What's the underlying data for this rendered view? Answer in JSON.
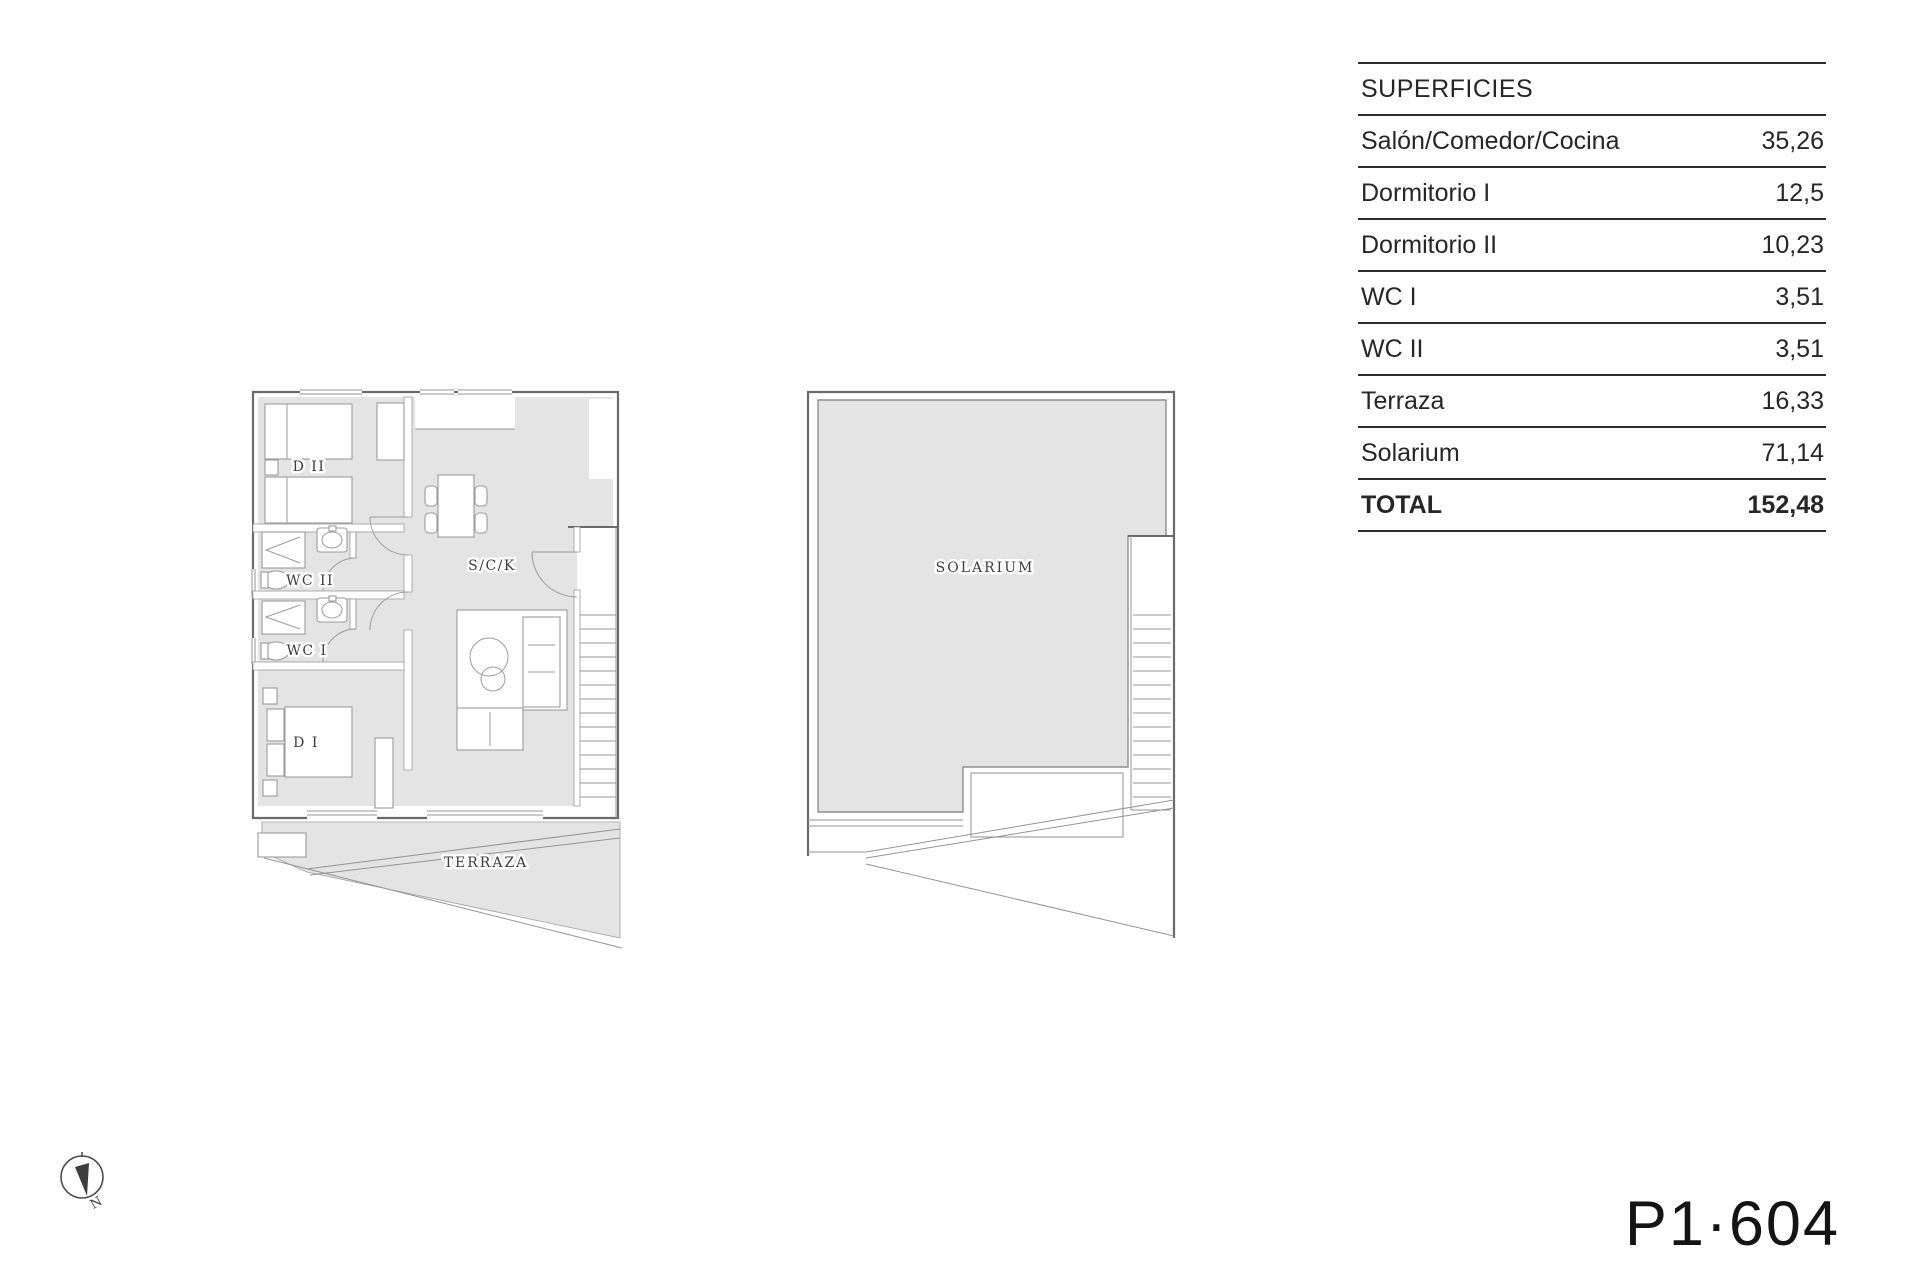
{
  "sheet": {
    "code": "P1·604"
  },
  "table": {
    "header": "SUPERFICIES",
    "rows": [
      {
        "label": "Salón/Comedor/Cocina",
        "value": "35,26"
      },
      {
        "label": "Dormitorio I",
        "value": "12,5"
      },
      {
        "label": "Dormitorio II",
        "value": "10,23"
      },
      {
        "label": "WC I",
        "value": "3,51"
      },
      {
        "label": "WC II",
        "value": "3,51"
      },
      {
        "label": "Terraza",
        "value": "16,33"
      },
      {
        "label": "Solarium",
        "value": "71,14"
      }
    ],
    "total_label": "TOTAL",
    "total_value": "152,48"
  },
  "floorplan": {
    "rooms": {
      "dormitorio2": "D II",
      "wc2": "WC II",
      "wc1": "WC I",
      "dormitorio1": "D I",
      "salon": "S/C/K",
      "terraza": "TERRAZA",
      "solarium": "SOLARIUM"
    }
  },
  "compass": {
    "north": "N"
  },
  "colors": {
    "floor": "#e4e4e4",
    "wall": "#6a6a6a",
    "table_line": "#2e2e2e",
    "text": "#262626"
  }
}
